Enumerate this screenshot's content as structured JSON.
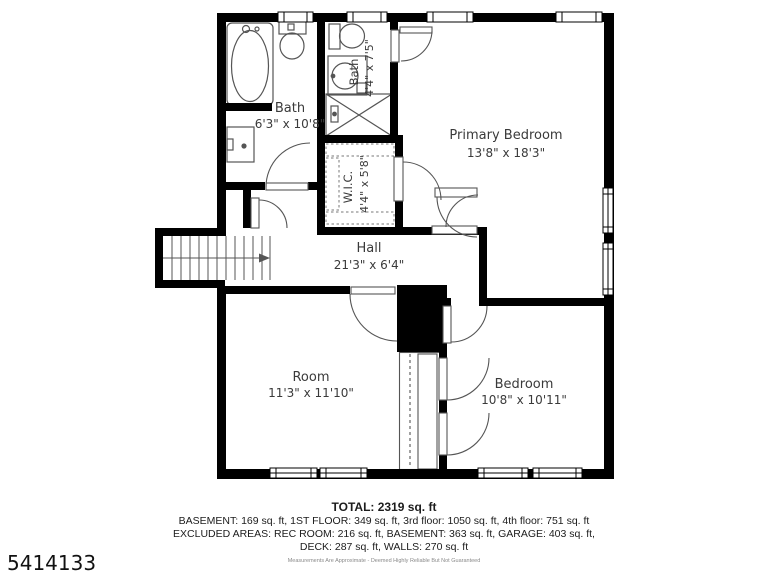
{
  "floorplan": {
    "rooms": {
      "bath": {
        "name": "Bath",
        "dims": "6'3\" x 10'8\""
      },
      "bath_small": {
        "name": "Bath",
        "dims": "4'4\" x 7'5\""
      },
      "wic": {
        "name": "W.I.C.",
        "dims": "4'4\" x 5'8\""
      },
      "hall": {
        "name": "Hall",
        "dims": "21'3\" x 6'4\""
      },
      "primary_bedroom": {
        "name": "Primary Bedroom",
        "dims": "13'8\" x 18'3\""
      },
      "room": {
        "name": "Room",
        "dims": "11'3\" x 11'10\""
      },
      "bedroom": {
        "name": "Bedroom",
        "dims": "10'8\" x 10'11\""
      }
    },
    "summary": {
      "total": "TOTAL: 2319 sq. ft",
      "line1": "BASEMENT: 169 sq. ft, 1ST FLOOR: 349 sq. ft, 3rd floor: 1050 sq. ft, 4th floor: 751 sq. ft",
      "line2": "EXCLUDED AREAS: REC ROOM: 216 sq. ft, BASEMENT: 363 sq. ft, GARAGE: 403 sq. ft,",
      "line3": "DECK: 287 sq. ft, WALLS: 270 sq. ft",
      "disclaimer": "Measurements Are Approximate - Deemed Highly Reliable But Not Guaranteed"
    },
    "listing_id": "5414133",
    "colors": {
      "wall": "#000000",
      "line": "#555555",
      "text": "#3a3a3a"
    }
  }
}
